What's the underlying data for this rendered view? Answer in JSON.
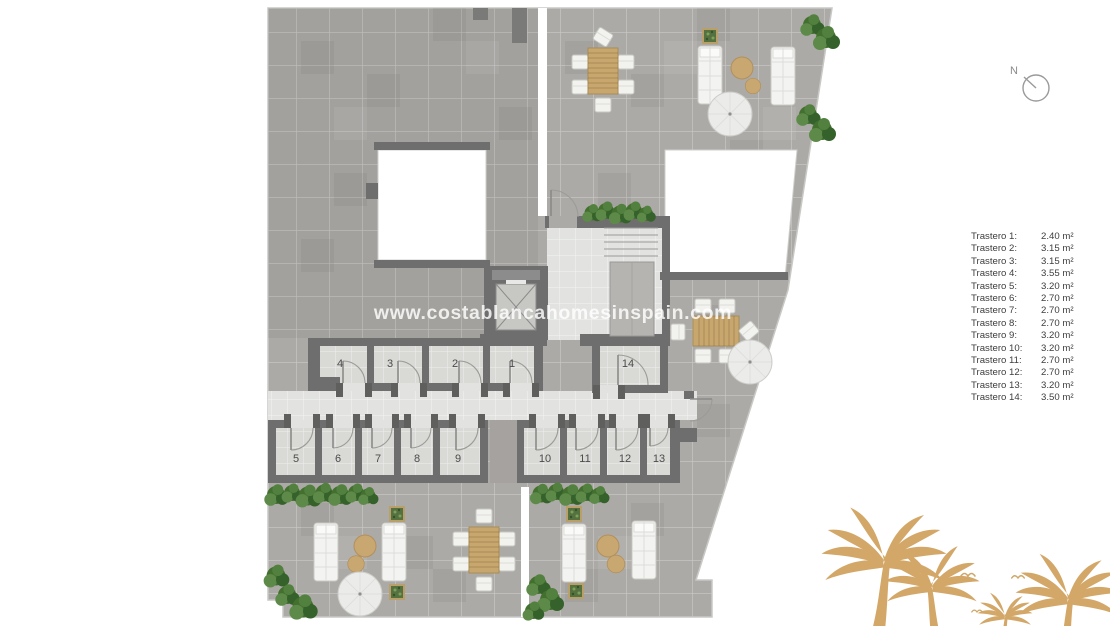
{
  "watermark": {
    "text": "www.costablancahomesinspain.com"
  },
  "compass": {
    "label": "N"
  },
  "legend": {
    "items": [
      {
        "name": "Trastero 1:",
        "area": "2.40 m²"
      },
      {
        "name": "Trastero 2:",
        "area": "3.15 m²"
      },
      {
        "name": "Trastero 3:",
        "area": "3.15 m²"
      },
      {
        "name": "Trastero 4:",
        "area": "3.55 m²"
      },
      {
        "name": "Trastero 5:",
        "area": "3.20 m²"
      },
      {
        "name": "Trastero 6:",
        "area": "2.70 m²"
      },
      {
        "name": "Trastero 7:",
        "area": "2.70 m²"
      },
      {
        "name": "Trastero 8:",
        "area": "2.70 m²"
      },
      {
        "name": "Trastero 9:",
        "area": "3.20 m²"
      },
      {
        "name": "Trastero 10:",
        "area": "3.20 m²"
      },
      {
        "name": "Trastero 11:",
        "area": "2.70 m²"
      },
      {
        "name": "Trastero 12:",
        "area": "2.70 m²"
      },
      {
        "name": "Trastero 13:",
        "area": "3.20 m²"
      },
      {
        "name": "Trastero 14:",
        "area": "3.50 m²"
      }
    ]
  },
  "rooms": [
    {
      "label": "1"
    },
    {
      "label": "2"
    },
    {
      "label": "3"
    },
    {
      "label": "4"
    },
    {
      "label": "5"
    },
    {
      "label": "6"
    },
    {
      "label": "7"
    },
    {
      "label": "8"
    },
    {
      "label": "9"
    },
    {
      "label": "10"
    },
    {
      "label": "11"
    },
    {
      "label": "12"
    },
    {
      "label": "13"
    },
    {
      "label": "14"
    }
  ],
  "colors": {
    "wall": "#6e6e6e",
    "terrace": "#acaaa6",
    "room_tile": "#d9d9d6",
    "corridor_tile": "#e2e3e0",
    "hedge_green": "#44702f",
    "wood": "#c8a76f",
    "pouf_tan": "#c9a771",
    "palm_decor": "#d3a768",
    "legend_text": "#3d3d3d",
    "watermark_white": "rgba(255,255,255,0.8)"
  }
}
